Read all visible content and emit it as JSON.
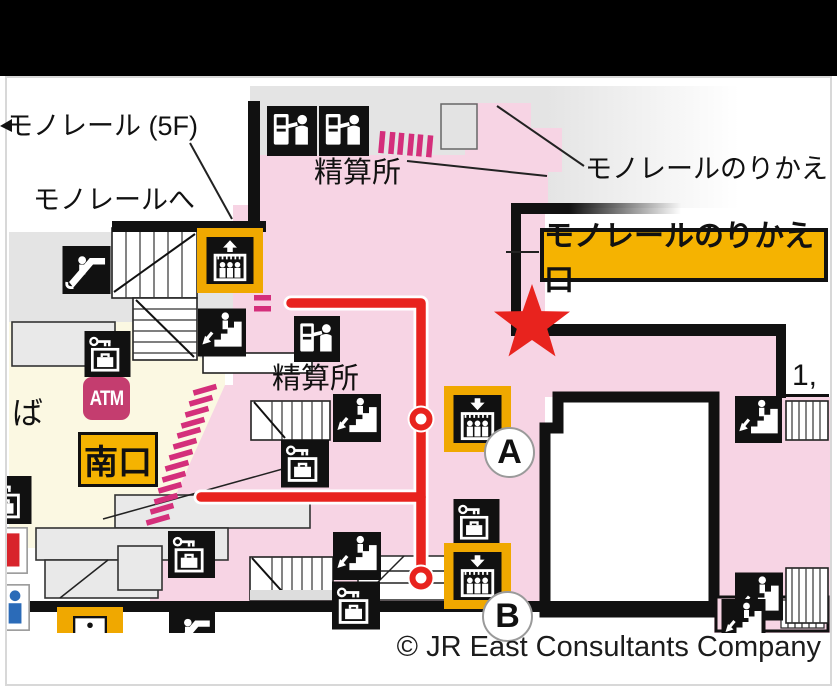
{
  "page": {
    "copyright": "© JR East Consultants Company"
  },
  "labels": {
    "monorail_5f": "モノレール (5F)",
    "to_monorail": "モノレールへ",
    "fare_office_top": "精算所",
    "fare_office_mid": "精算所",
    "monorail_transfer": "モノレールのりかえ",
    "monorail_transfer_gate": "モノレールのりかえ口",
    "south_exit": "南口",
    "atm": "ATM",
    "boarding_partial": "ば",
    "platform_numbers": "1,",
    "elevator_a": "A",
    "elevator_b": "B"
  },
  "colors": {
    "paid_area_pink": "#F7D4E4",
    "free_area_cream": "#FBF8E2",
    "corridor_gray": "#E4E4E4",
    "gate_magenta": "#D42F7B",
    "route_red": "#E8231E",
    "highlight_yellow": "#F5B301",
    "elevator_pad_yellow": "#F0A800",
    "atm_rose": "#C43D6F",
    "wall_black": "#111111"
  },
  "map": {
    "icons": [
      {
        "type": "escalator",
        "name": "escalator-icon",
        "x": 62,
        "y": 246,
        "w": 49,
        "h": 48
      },
      {
        "type": "elevator-up",
        "name": "elevator-up-icon",
        "x": 197,
        "y": 228,
        "w": 66,
        "h": 65,
        "frame": "gold"
      },
      {
        "type": "fare-machine",
        "name": "fare-adjustment-machine-icon",
        "x": 266,
        "y": 106,
        "w": 52,
        "h": 50
      },
      {
        "type": "fare-machine",
        "name": "fare-adjustment-machine-icon",
        "x": 318,
        "y": 106,
        "w": 52,
        "h": 50
      },
      {
        "type": "stairs-down",
        "name": "stairs-down-icon",
        "x": 198,
        "y": 308,
        "w": 48,
        "h": 49
      },
      {
        "type": "fare-machine",
        "name": "fare-adjustment-machine-icon",
        "x": 293,
        "y": 316,
        "w": 48,
        "h": 46
      },
      {
        "type": "locker",
        "name": "coin-locker-icon",
        "x": 84,
        "y": 331,
        "w": 47,
        "h": 46
      },
      {
        "type": "locker",
        "name": "coin-locker-icon",
        "x": 281,
        "y": 439,
        "w": 48,
        "h": 49
      },
      {
        "type": "stairs-down",
        "name": "stairs-down-icon",
        "x": 333,
        "y": 394,
        "w": 48,
        "h": 48
      },
      {
        "type": "stairs-down",
        "name": "stairs-down-icon",
        "x": 333,
        "y": 531,
        "w": 48,
        "h": 50
      },
      {
        "type": "locker",
        "name": "coin-locker-icon",
        "x": 332,
        "y": 581,
        "w": 48,
        "h": 49
      },
      {
        "type": "locker",
        "name": "coin-locker-icon",
        "x": 168,
        "y": 531,
        "w": 47,
        "h": 47
      },
      {
        "type": "elevator-down",
        "name": "elevator-down-icon",
        "x": 444,
        "y": 386,
        "w": 67,
        "h": 66,
        "frame": "gold"
      },
      {
        "type": "locker",
        "name": "coin-locker-icon",
        "x": 453,
        "y": 499,
        "w": 47,
        "h": 46
      },
      {
        "type": "elevator-down",
        "name": "elevator-down-icon",
        "x": 444,
        "y": 543,
        "w": 67,
        "h": 66,
        "frame": "gold"
      },
      {
        "type": "stairs-down",
        "name": "stairs-down-icon",
        "x": 735,
        "y": 396,
        "w": 47,
        "h": 47
      },
      {
        "type": "stairs-down",
        "name": "stairs-down-icon",
        "x": 735,
        "y": 571,
        "w": 48,
        "h": 51
      },
      {
        "type": "stairs-down",
        "name": "stairs-down-icon",
        "x": 719,
        "y": 599,
        "w": 49,
        "h": 44
      },
      {
        "type": "escalator",
        "name": "escalator-icon",
        "x": 169,
        "y": 609,
        "w": 46,
        "h": 46
      },
      {
        "type": "info",
        "name": "information-icon",
        "x": 57,
        "y": 607,
        "w": 66,
        "h": 52,
        "frame": "gold",
        "bg": "#ffffff"
      },
      {
        "type": "locker",
        "name": "coin-locker-icon",
        "x": -17,
        "y": 476,
        "w": 49,
        "h": 48
      },
      {
        "type": "red-partial",
        "name": "service-icon-partial",
        "x": -19,
        "y": 527,
        "w": 47,
        "h": 47,
        "bg": "#ffffff"
      },
      {
        "type": "blue-partial",
        "name": "service-icon-partial",
        "x": -17,
        "y": 582,
        "w": 47,
        "h": 51,
        "bg": "#ffffff"
      }
    ]
  }
}
